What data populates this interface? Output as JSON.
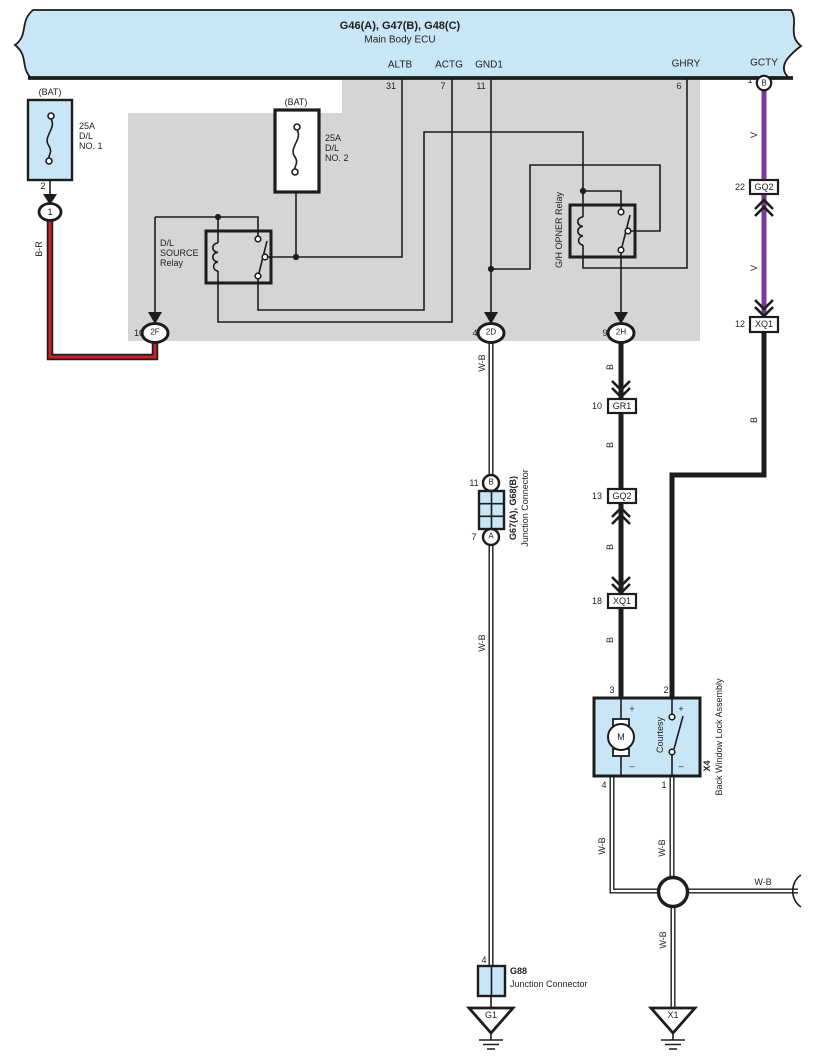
{
  "ecu": {
    "title": "G46(A), G47(B), G48(C)",
    "subtitle": "Main Body ECU",
    "pins": {
      "altb": {
        "label": "ALTB",
        "number": "31"
      },
      "actg": {
        "label": "ACTG",
        "number": "7"
      },
      "gnd1": {
        "label": "GND1",
        "number": "11"
      },
      "ghry": {
        "label": "GHRY",
        "number": "6"
      },
      "gcty": {
        "label": "GCTY",
        "number": "1",
        "terminal": "B"
      }
    }
  },
  "fuses": {
    "no1": {
      "bat": "(BAT)",
      "text": "25A\nD/L\nNO. 1",
      "pin": "2",
      "terminal": "1"
    },
    "no2": {
      "bat": "(BAT)",
      "text": "25A\nD/L\nNO. 2"
    }
  },
  "relays": {
    "dl_source": {
      "label": "D/L\nSOURCE\nRelay"
    },
    "gh_opner": {
      "label": "G/H OPNER Relay"
    }
  },
  "ecu_connectors": {
    "f2": {
      "number": "10",
      "code": "2F"
    },
    "d2": {
      "number": "4",
      "code": "2D"
    },
    "h2": {
      "number": "9",
      "code": "2H"
    }
  },
  "inline_connectors": {
    "gr1": {
      "number": "10",
      "code": "GR1"
    },
    "gq2_mid": {
      "number": "13",
      "code": "GQ2"
    },
    "xq1_mid": {
      "number": "18",
      "code": "XQ1"
    },
    "gq2_right": {
      "number": "22",
      "code": "GQ2"
    },
    "xq1_right": {
      "number": "12",
      "code": "XQ1"
    }
  },
  "wire_labels": {
    "br": "B-R",
    "wb": "W-B",
    "b": "B",
    "v": "V"
  },
  "junction_g67": {
    "pin_top": "11",
    "terminal_top": "B",
    "pin_bottom": "7",
    "terminal_bottom": "A",
    "name": "G67(A), G68(B)",
    "type": "Junction Connector"
  },
  "junction_g88": {
    "pin": "4",
    "name": "G88",
    "type": "Junction Connector"
  },
  "x4": {
    "name": "X4",
    "type": "Back Window Lock Assembly",
    "pin_motor_top": "3",
    "pin_switch_top": "2",
    "pin_motor_bottom": "4",
    "pin_switch_bottom": "1",
    "motor": "M",
    "switch": "Courtesy",
    "plus": "+",
    "minus": "–"
  },
  "grounds": {
    "g1": "G1",
    "x1": "X1"
  },
  "colors": {
    "component_blue": "#c8e6f6",
    "shield_gray": "#d5d5d6",
    "wire_red": "#cc2127",
    "wire_violet": "#7b3a96",
    "line_black": "#1d1d1f"
  }
}
